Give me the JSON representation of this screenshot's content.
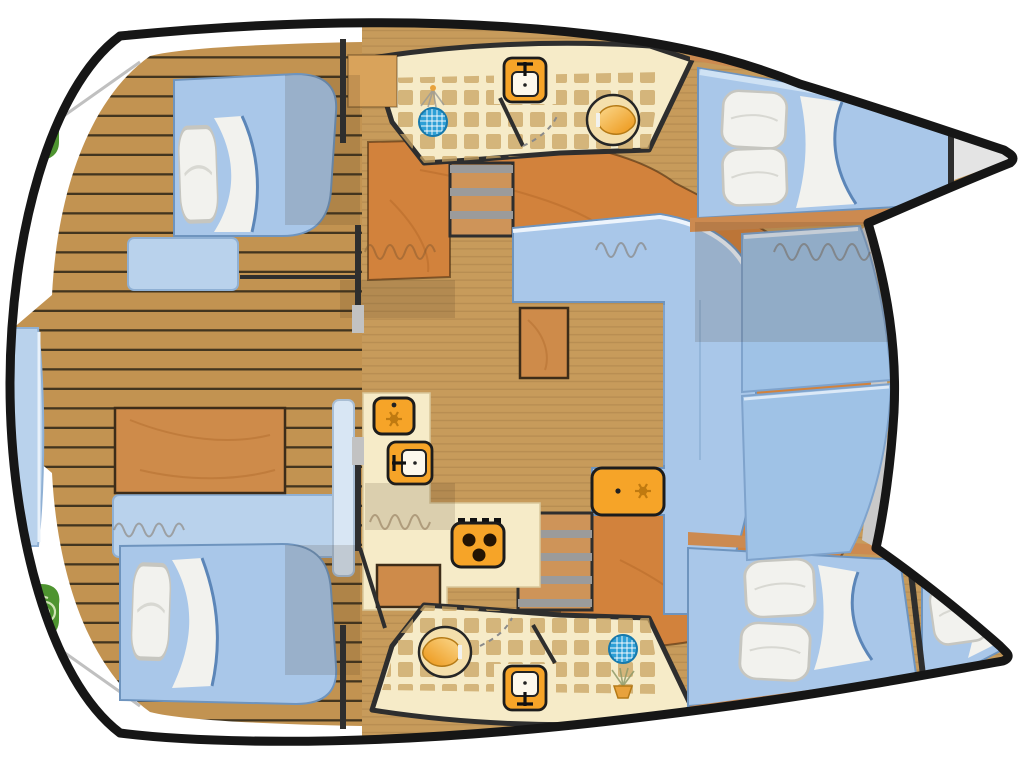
{
  "diagram": {
    "title": "Catamaran yacht interior layout plan, bow to the right",
    "type": "boat-floor-plan",
    "orientation": {
      "bow": "right",
      "stern": "left"
    },
    "rooms": {
      "cockpit": {
        "label": "Aft cockpit with teak deck, dinette table, bench seating and twin engine hatches"
      },
      "cabin_top_aft": {
        "label": "Port aft cabin with double berth"
      },
      "bath_top": {
        "label": "Port bathroom with shower, washbasin and toilet"
      },
      "cabin_top_fwd": {
        "label": "Port forward cabin with double berth"
      },
      "forepeak_top": {
        "label": "Port bow sail locker"
      },
      "salon": {
        "label": "Salon with L-settee, coffee table, cabinet and cool box"
      },
      "galley": {
        "label": "Galley with refrigerator, sink and stove"
      },
      "foredeck": {
        "label": "Forward cockpit sunpad cushions"
      },
      "cabin_bot_aft": {
        "label": "Starboard aft cabin with double berth"
      },
      "bath_bot": {
        "label": "Starboard bathroom with toilet, washbasin and shower"
      },
      "cabin_bot_fwd": {
        "label": "Starboard forward cabin with double berth"
      },
      "skipper_berth": {
        "label": "Starboard bow skipper berth"
      }
    },
    "fixtures": [
      "engine-icon",
      "engine-icon",
      "shower-drain-icon",
      "shower-drain-icon",
      "washbasin-icon",
      "washbasin-icon",
      "toilet-icon",
      "toilet-icon",
      "fridge-icon",
      "galley-sink-icon",
      "stove-icon",
      "coolbox-icon",
      "companionway-steps",
      "companionway-steps",
      "pillow-icon",
      "pillow-icon",
      "pillow-icon",
      "pillow-icon",
      "pillow-icon",
      "pillow-icon",
      "pillow-icon",
      "pillow-icon"
    ],
    "counts": {
      "cabins": 4,
      "extra_berths": 1,
      "bathrooms": 2,
      "engines": 2,
      "stove_burners": 3
    }
  },
  "colors": {
    "hullStroke": "#161616",
    "wallDark": "#2e2e2e",
    "interiorTan": "#c79b5b",
    "plankTan": "#c29351",
    "plankLine": "#2b2416",
    "cabinetOrange": "#d2823c",
    "woodMid": "#ce8b4a",
    "cream": "#f6ebc8",
    "tileBrown": "#c8a261",
    "bedBlue": "#a9c7e9",
    "cushionBlue": "#9fc2e6",
    "seatLight": "#b9d2ec",
    "pillowWhite": "#f2f2ee",
    "sheetWhite": "#f2f2ee",
    "applianceOrange": "#f6a428",
    "applianceDetail": "#c07a10",
    "drainBlue": "#2d9fd6",
    "engineGreen": "#4e9430",
    "forepeakGray": "#e4e4e4",
    "walkwayGray": "#c9c9c9",
    "treadGray": "#9b9b9b"
  }
}
